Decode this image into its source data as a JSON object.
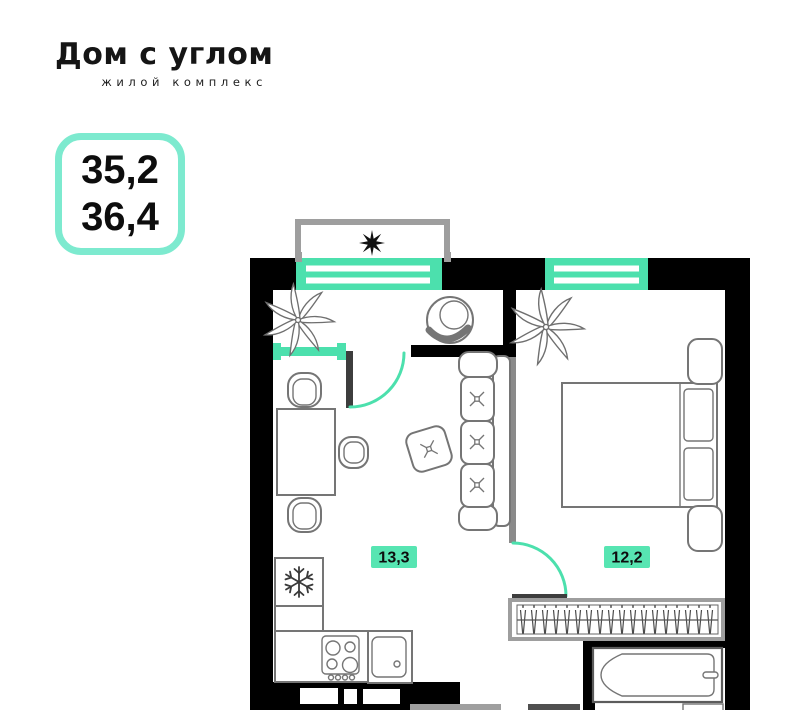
{
  "logo": {
    "title": "Дом с углом",
    "subtitle": "жилой комплекс"
  },
  "area_badge": {
    "line1": "35,2",
    "line2": "36,4"
  },
  "floor_plan": {
    "rooms": [
      {
        "id": "kitchen_living",
        "area_label": "13,3"
      },
      {
        "id": "bedroom",
        "area_label": "12,2"
      }
    ]
  },
  "colors": {
    "accent": "#4ce0ad",
    "badge_border": "#7deacf",
    "label_bg": "#57e5b2",
    "wall": "#000000",
    "partition": "#8a8a8a",
    "door_leaf": "#3d3d3d",
    "furniture": "#757575",
    "frame_gray": "#9e9e9e"
  }
}
